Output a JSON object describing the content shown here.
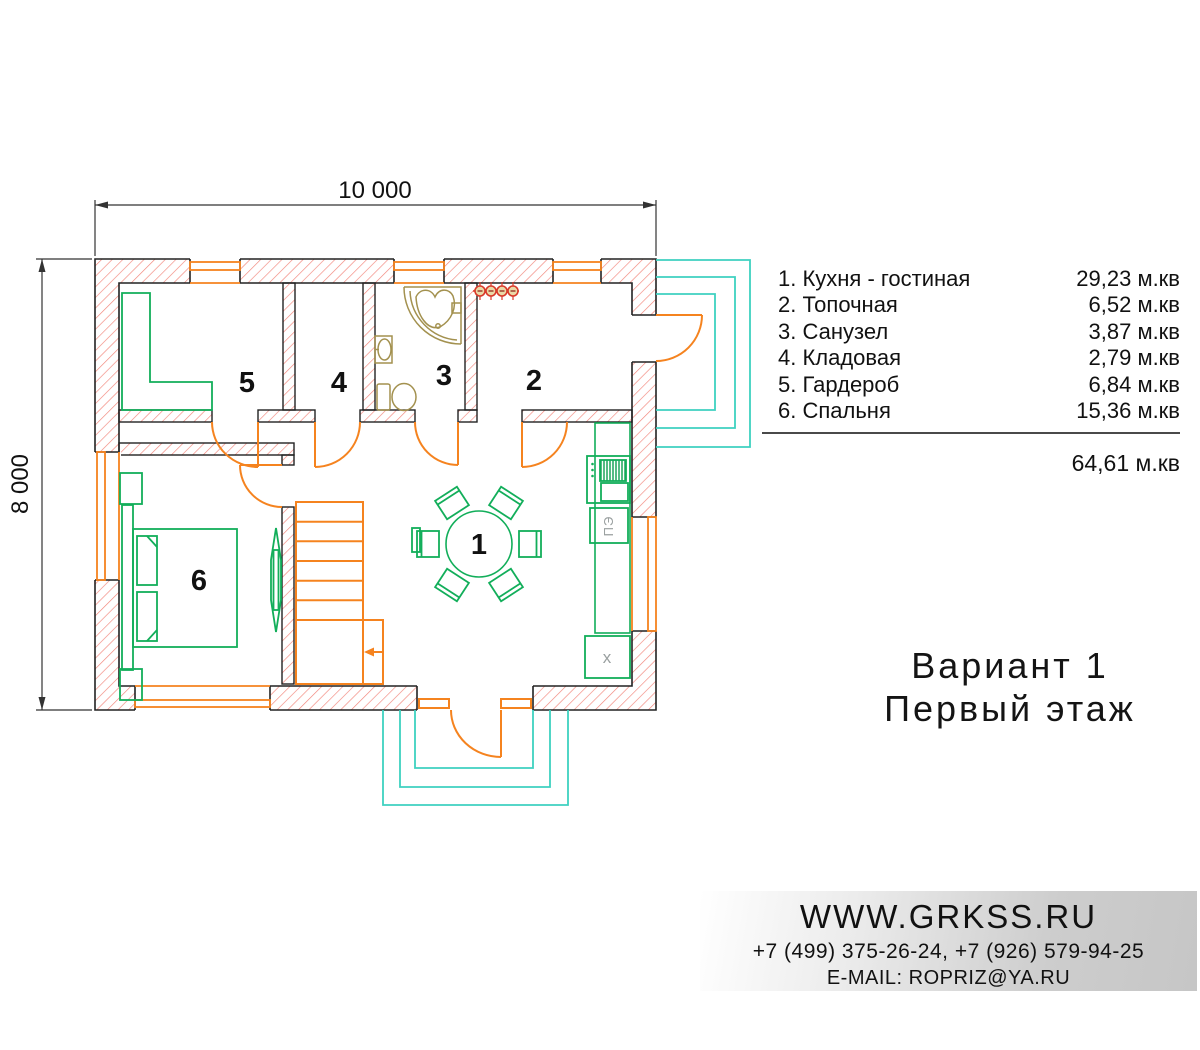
{
  "dimensions": {
    "top": "10 000",
    "left": "8 000"
  },
  "legend": {
    "items": [
      {
        "label": "1. Кухня - гостиная",
        "area": "29,23 м.кв"
      },
      {
        "label": "2. Топочная",
        "area": "6,52 м.кв"
      },
      {
        "label": "3. Санузел",
        "area": "3,87 м.кв"
      },
      {
        "label": "4. Кладовая",
        "area": "2,79 м.кв"
      },
      {
        "label": "5. Гардероб",
        "area": "6,84 м.кв"
      },
      {
        "label": "6. Спальня",
        "area": "15,36 м.кв"
      }
    ],
    "total": "64,61 м.кв"
  },
  "title": {
    "line1": "Вариант 1",
    "line2": "Первый этаж"
  },
  "footer": {
    "website": "WWW.GRKSS.RU",
    "phones": "+7 (499) 375-26-24, +7 (926) 579-94-25",
    "email": "E-MAIL: ROPRIZ@YA.RU"
  },
  "plan": {
    "room_numbers": [
      "1",
      "2",
      "3",
      "4",
      "5",
      "6"
    ],
    "stove_label": "ПЭ",
    "appliance_label": "x",
    "colors": {
      "wall_outline": "#222222",
      "wall_hatch_red": "#f2857a",
      "fittings_orange": "#f5831f",
      "furniture_green": "#12ae5a",
      "porch_cyan": "#3ed1c0",
      "sanitary_tan": "#a3914f",
      "radiator_red": "#d93a2b"
    }
  }
}
